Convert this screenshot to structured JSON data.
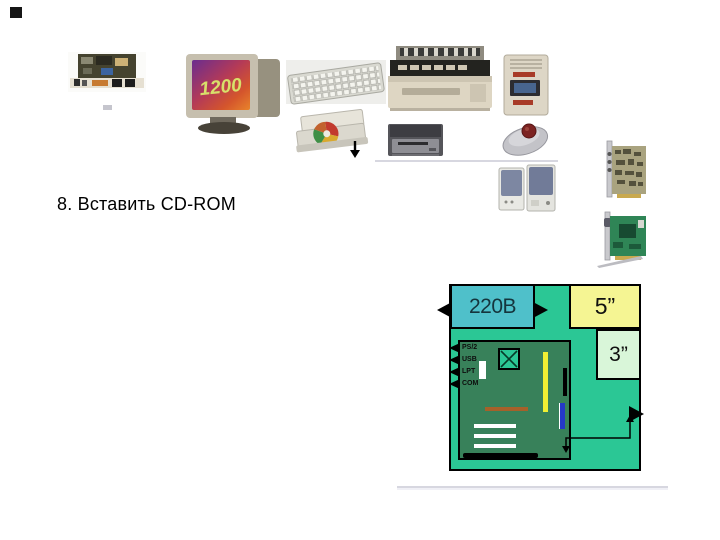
{
  "slide": {
    "caption": "8. Вставить CD-ROM",
    "monitor_screen_text": "1200"
  },
  "hardware_items": [
    "motherboard",
    "monitor",
    "keyboard",
    "printer",
    "power-unit",
    "cd-rom-drive",
    "floppy-drive",
    "mouse",
    "speakers",
    "sound-card",
    "video-card"
  ],
  "diagram": {
    "power_label": "220В",
    "bay5_label": "5”",
    "bay3_label": "3”",
    "port_labels": [
      "PS/2",
      "USB",
      "LPT",
      "COM"
    ],
    "colors": {
      "case": "#2bc795",
      "power_box": "#4fc0ca",
      "bay5": "#f5f593",
      "bay3": "#d9f6d9",
      "motherboard": "#38815a",
      "ram_bar": "#f0f033",
      "slot_blue": "#2438c8",
      "slot_brown": "#a5612a",
      "slot_white": "#ffffff"
    }
  }
}
